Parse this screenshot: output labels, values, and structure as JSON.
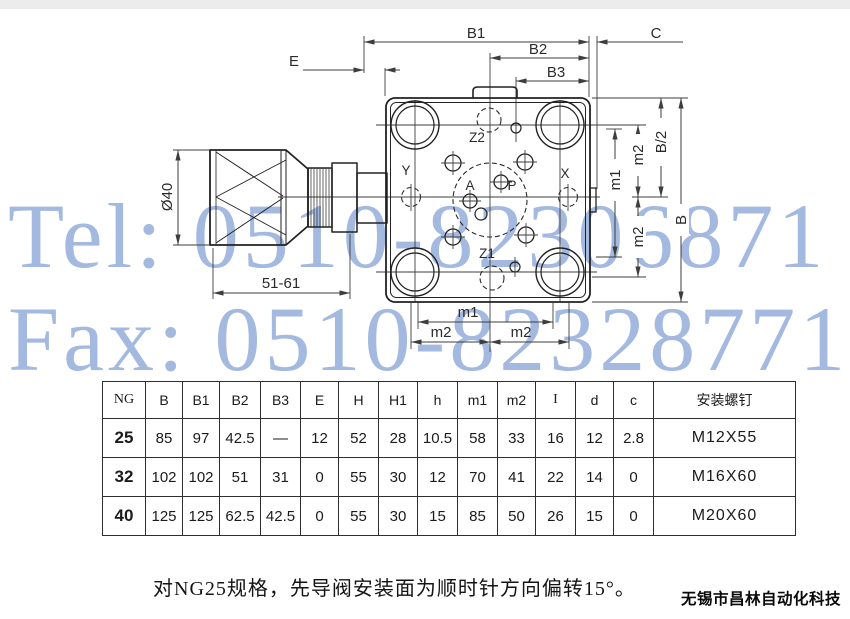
{
  "watermark": {
    "tel": "Tel: 0510-82306871",
    "fax": "Fax: 0510-82328771",
    "color": "#a4b9e0"
  },
  "drawing": {
    "dim_labels": {
      "b1": "B1",
      "b2": "B2",
      "b3": "B3",
      "c": "C",
      "e": "E",
      "dia": "Ø40",
      "knob_len": "51-61",
      "m1": "m1",
      "m2": "m2",
      "b_half": "B/2",
      "b": "B"
    },
    "port_labels": {
      "z2": "Z2",
      "z1": "Z1",
      "a": "A",
      "p": "P",
      "x": "X",
      "y": "Y"
    }
  },
  "table": {
    "headers": [
      "NG",
      "B",
      "B1",
      "B2",
      "B3",
      "E",
      "H",
      "H1",
      "h",
      "m1",
      "m2",
      "I",
      "d",
      "c",
      "安装螺钉"
    ],
    "rows": [
      [
        "25",
        "85",
        "97",
        "42.5",
        "—",
        "12",
        "52",
        "28",
        "10.5",
        "58",
        "33",
        "16",
        "12",
        "2.8",
        "M12X55"
      ],
      [
        "32",
        "102",
        "102",
        "51",
        "31",
        "0",
        "55",
        "30",
        "12",
        "70",
        "41",
        "22",
        "14",
        "0",
        "M16X60"
      ],
      [
        "40",
        "125",
        "125",
        "62.5",
        "42.5",
        "0",
        "55",
        "30",
        "15",
        "85",
        "50",
        "26",
        "15",
        "0",
        "M20X60"
      ]
    ]
  },
  "note": "对NG25规格，先导阀安装面为顺时针方向偏转15°。",
  "company": "无锡市昌林自动化科技"
}
